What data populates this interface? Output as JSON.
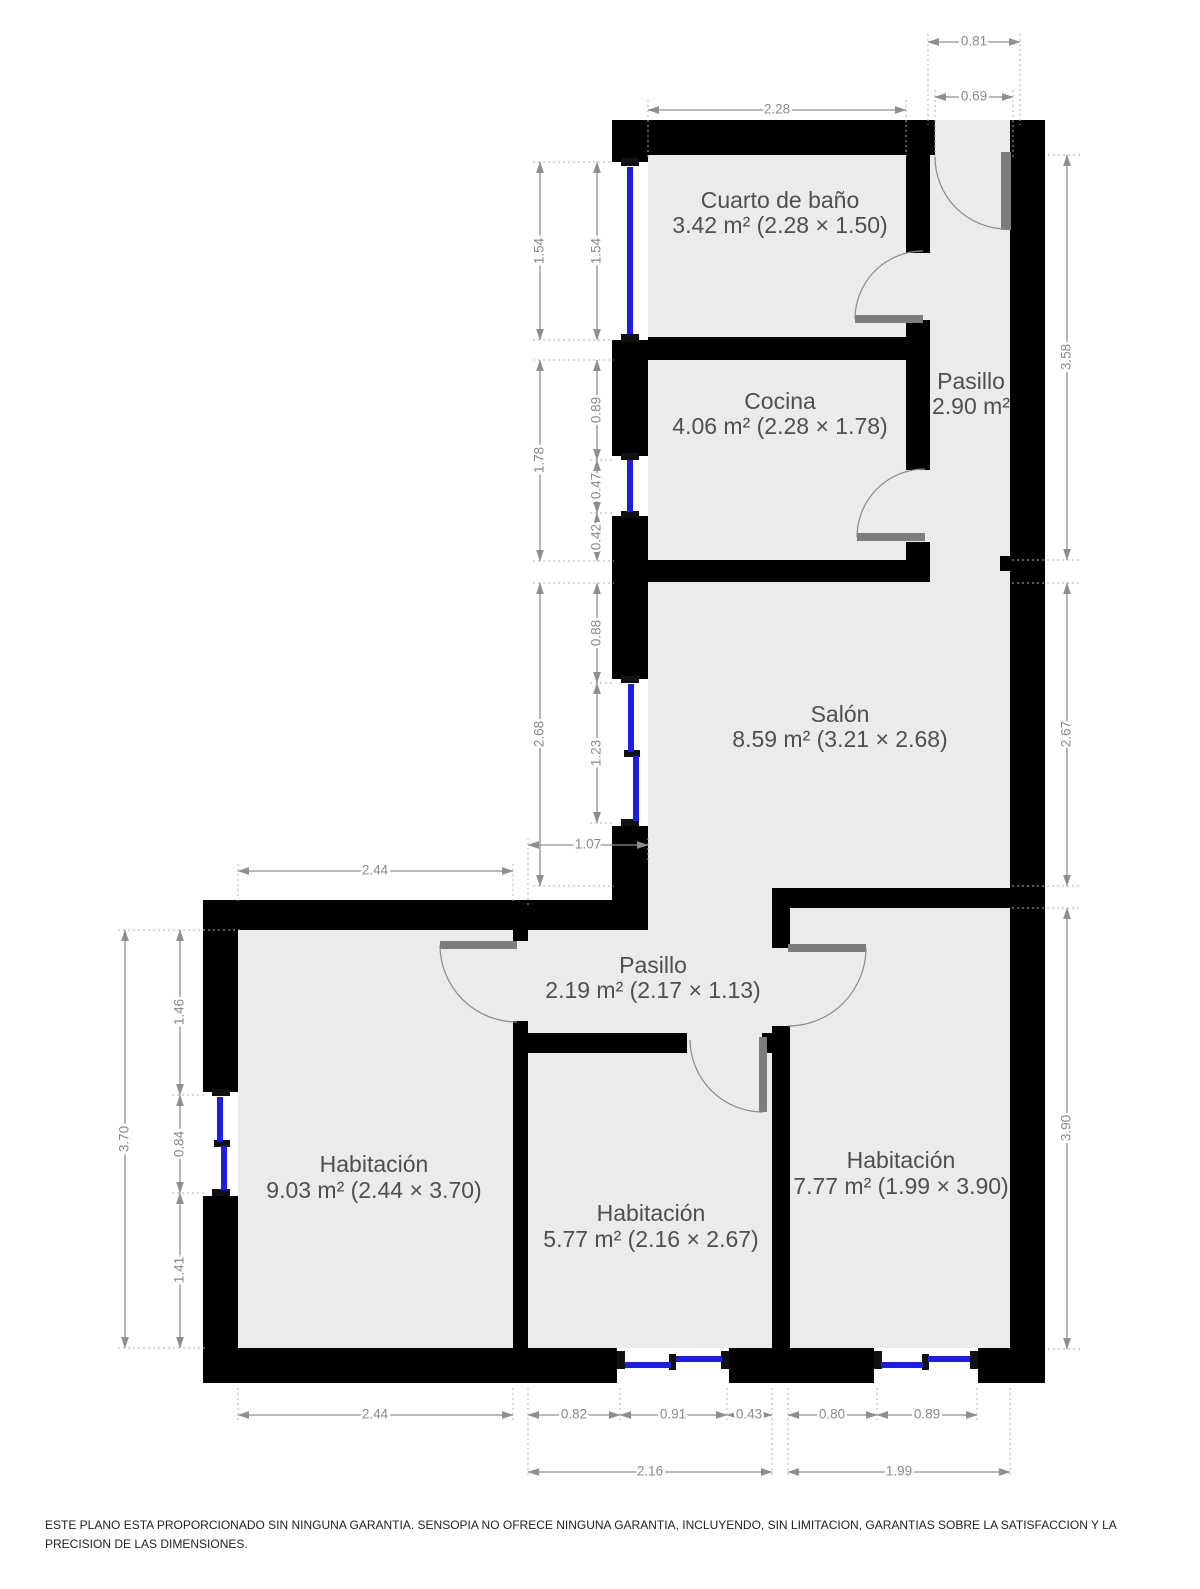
{
  "plan": {
    "rooms": {
      "bathroom": {
        "name": "Cuarto de baño",
        "area": "3.42 m² (2.28 × 1.50)"
      },
      "kitchen": {
        "name": "Cocina",
        "area": "4.06 m² (2.28 × 1.78)"
      },
      "hallway_upper": {
        "name": "Pasillo",
        "area": "2.90 m²"
      },
      "living_room": {
        "name": "Salón",
        "area": "8.59 m² (3.21 × 2.68)"
      },
      "hallway_lower": {
        "name": "Pasillo",
        "area": "2.19 m² (2.17 × 1.13)"
      },
      "bedroom_left": {
        "name": "Habitación",
        "area": "9.03 m² (2.44 × 3.70)"
      },
      "bedroom_middle": {
        "name": "Habitación",
        "area": "5.77 m² (2.16 × 2.67)"
      },
      "bedroom_right": {
        "name": "Habitación",
        "area": "7.77 m² (1.99 × 3.90)"
      }
    },
    "dims": {
      "w_228": "2.28",
      "w_081": "0.81",
      "w_069": "0.69",
      "lo_154": "1.54",
      "lo_178": "1.78",
      "lo_268": "2.68",
      "li_154": "1.54",
      "li_089": "0.89",
      "li_047": "0.47",
      "li_042": "0.42",
      "li_088": "0.88",
      "li_123": "1.23",
      "w_107": "1.07",
      "r_358": "3.58",
      "r_267": "2.67",
      "r_390": "3.90",
      "t_244": "2.44",
      "llo_370": "3.70",
      "lli_146": "1.46",
      "lli_084": "0.84",
      "lli_141": "1.41",
      "b_244": "2.44",
      "b_082": "0.82",
      "b_091": "0.91",
      "b_043": "0.43",
      "b_080": "0.80",
      "b_089": "0.89",
      "b_216": "2.16",
      "b_199": "1.99"
    },
    "colors": {
      "wall": "#000000",
      "floor": "#ebebeb",
      "window_glass": "#1e1ee0",
      "door_leaf": "#7d7d7d",
      "dimension": "#8a8a8a",
      "label_text": "#4f4f4f"
    },
    "disclaimer": "ESTE PLANO ESTA PROPORCIONADO SIN NINGUNA GARANTIA. SENSOPIA NO OFRECE NINGUNA GARANTIA, INCLUYENDO, SIN LIMITACION, GARANTIAS SOBRE LA SATISFACCION Y LA PRECISION DE LAS DIMENSIONES."
  }
}
